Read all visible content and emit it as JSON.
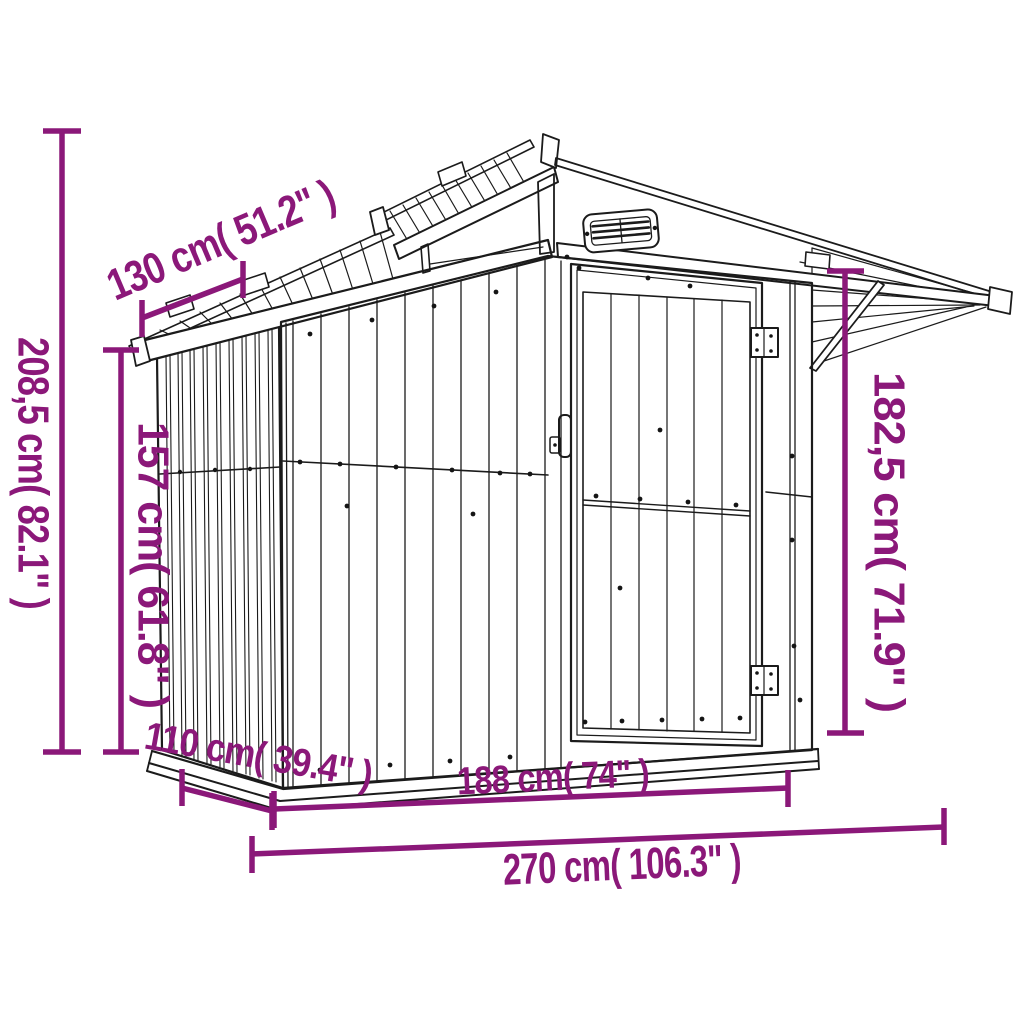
{
  "diagram": {
    "subject": "garden-shed-dimension-drawing",
    "background_color": "#ffffff",
    "dimension_color": "#8B1879",
    "line_color": "#1b1b1b",
    "dimensions": [
      {
        "id": "total-height",
        "label": "208,5 cm( 82.1\" )",
        "cm": "208,5",
        "inches": "82.1"
      },
      {
        "id": "wall-height",
        "label": "157 cm( 61.8\" )",
        "cm": "157",
        "inches": "61.8"
      },
      {
        "id": "roof-depth",
        "label": "130 cm( 51.2\" )",
        "cm": "130",
        "inches": "51.2"
      },
      {
        "id": "eave-height",
        "label": "182,5 cm( 71.9\" )",
        "cm": "182,5",
        "inches": "71.9"
      },
      {
        "id": "base-depth",
        "label": "110 cm( 39.4\" )",
        "cm": "110",
        "inches": "39.4"
      },
      {
        "id": "front-width",
        "label": "188 cm( 74\" )",
        "cm": "188",
        "inches": "74"
      },
      {
        "id": "total-width",
        "label": "270 cm( 106.3\" )",
        "cm": "270",
        "inches": "106.3"
      }
    ]
  }
}
